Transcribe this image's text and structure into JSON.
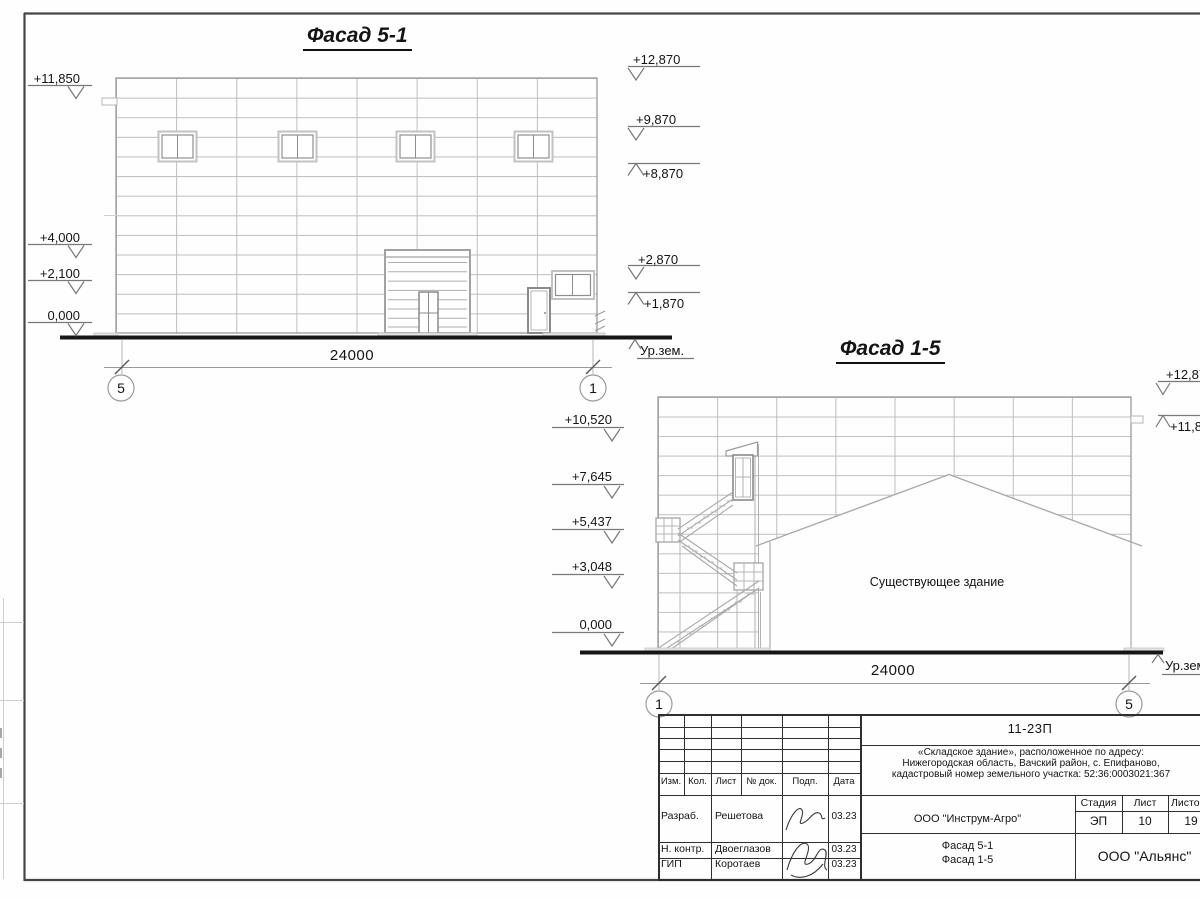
{
  "drawing": {
    "f51": {
      "title": "Фасад 5-1",
      "dim": "24000",
      "axis_left": "5",
      "axis_right": "1",
      "ground": "Ур.зем.",
      "elev_left": [
        "+11,850",
        "+4,000",
        "+2,100",
        "0,000"
      ],
      "elev_right": [
        "+12,870",
        "+9,870",
        "+8,870",
        "+2,870",
        "+1,870"
      ]
    },
    "f15": {
      "title": "Фасад 1-5",
      "dim": "24000",
      "axis_left": "1",
      "axis_right": "5",
      "ground": "Ур.зем.",
      "existing": "Существующее здание",
      "elev_left": [
        "+10,520",
        "+7,645",
        "+5,437",
        "+3,048",
        "0,000"
      ],
      "elev_right": [
        "+12,870",
        "+11,850"
      ]
    },
    "titleblock": {
      "doc": "11-23П",
      "desc1": "«Складское здание», расположенное по адресу:",
      "desc2": "Нижегородская область, Вачский район, с. Епифаново,",
      "desc3": "кадастровый номер земельного участка: 52:36:0003021:367",
      "client": "ООО \"Инструм-Агро\"",
      "stage_h": "Стадия",
      "list_h": "Лист",
      "listov_h": "Листов",
      "stage": "ЭП",
      "list": "10",
      "listov": "19",
      "content1": "Фасад 5-1",
      "content2": "Фасад 1-5",
      "company": "ООО \"Альянс\"",
      "col_izm": "Изм.",
      "col_kol": "Кол.",
      "col_list": "Лист",
      "col_ndok": "№ док.",
      "col_podp": "Подп.",
      "col_data": "Дата",
      "rows": [
        {
          "role": "Разраб.",
          "name": "Решетова",
          "date": "03.23"
        },
        {
          "role": "Н. контр.",
          "name": "Двоеглазов",
          "date": "03.23"
        },
        {
          "role": "ГИП",
          "name": "Коротаев",
          "date": "03.23"
        }
      ]
    }
  }
}
